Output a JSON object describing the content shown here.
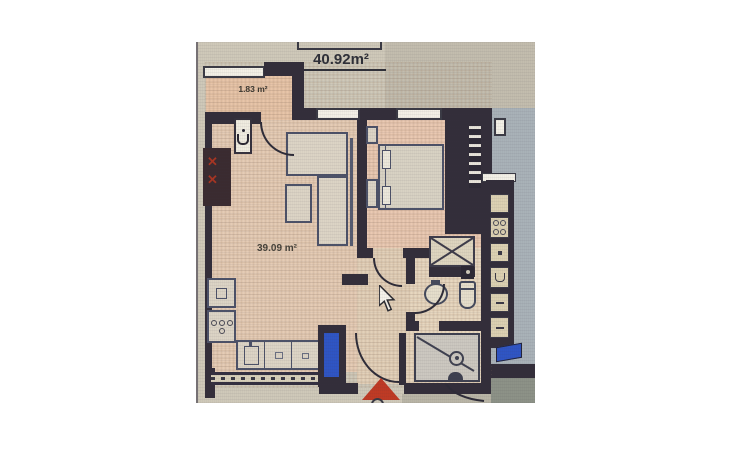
{
  "floorplan": {
    "labels": {
      "total_area": "40.92m²",
      "balcony_area": "1.83 m²",
      "living_area": "39.09 m²"
    },
    "icons": {
      "entrance_arrow": "red-triangle-up",
      "mouse_cursor": "arrow-pointer"
    },
    "colors": {
      "photo_background": "#cfc9b9",
      "wall": "#332e3a",
      "living_floor": "#e5ccb5",
      "bedroom_floor": "#eac9b2",
      "balcony_floor": "#e8c5a8",
      "hall_floor": "#e3d1b9",
      "bath_floor": "#e7d7bf",
      "neighbor_floor": "#a9b2b8",
      "neighbor_lower_floor": "#8d9287",
      "furniture_fill": "#dcd4c5",
      "furniture_border": "#4d5268",
      "window_white": "#f3f0e6",
      "entrance_arrow_red": "#bf3a24",
      "door_highlight_blue": "#2f55c4",
      "label_text": "#2f3038"
    }
  }
}
